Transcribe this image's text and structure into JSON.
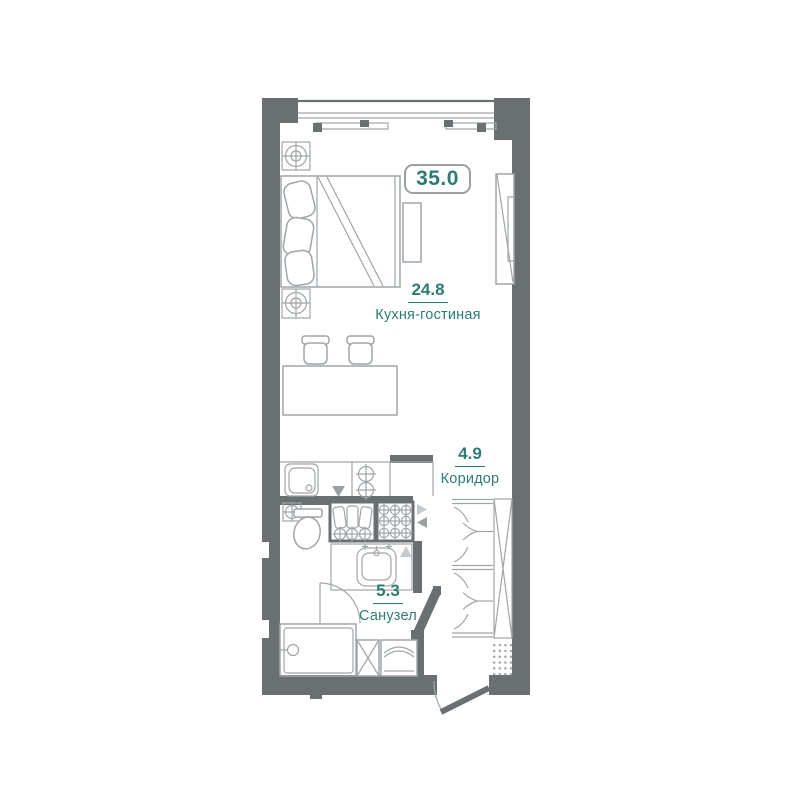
{
  "plan": {
    "total_area_badge": "35.0",
    "rooms": [
      {
        "id": "kitchen-living",
        "area": "24.8",
        "name": "Кухня-гостиная"
      },
      {
        "id": "corridor",
        "area": "4.9",
        "name": "Коридор"
      },
      {
        "id": "bathroom",
        "area": "5.3",
        "name": "Санузел"
      }
    ],
    "icons": [
      "window",
      "balcony-track",
      "ceiling-light-icon",
      "bed",
      "pillow-icon",
      "nightstand",
      "tv-panel-icon",
      "dining-table",
      "stool-icon",
      "kitchen-sink-icon",
      "hob-icon",
      "arrow-marker-icon",
      "vent-box-bottles-icon",
      "vent-box-grid-icon",
      "valve-icon",
      "toilet-icon",
      "bathroom-sink-icon",
      "bathtub-icon",
      "washing-machine-icon",
      "hatch-box-icon",
      "wardrobe",
      "hanger-icon",
      "shoe-mat-dots",
      "entrance-door",
      "door-arc"
    ]
  },
  "colors": {
    "wall": "#6a6f72",
    "line": "#a0a5a8",
    "light": "#c6c9cb",
    "mid": "#9ba0a3",
    "teal": "#2e7b74",
    "badge-border": "#9ba0a3",
    "dot": "#9ba0a3"
  }
}
